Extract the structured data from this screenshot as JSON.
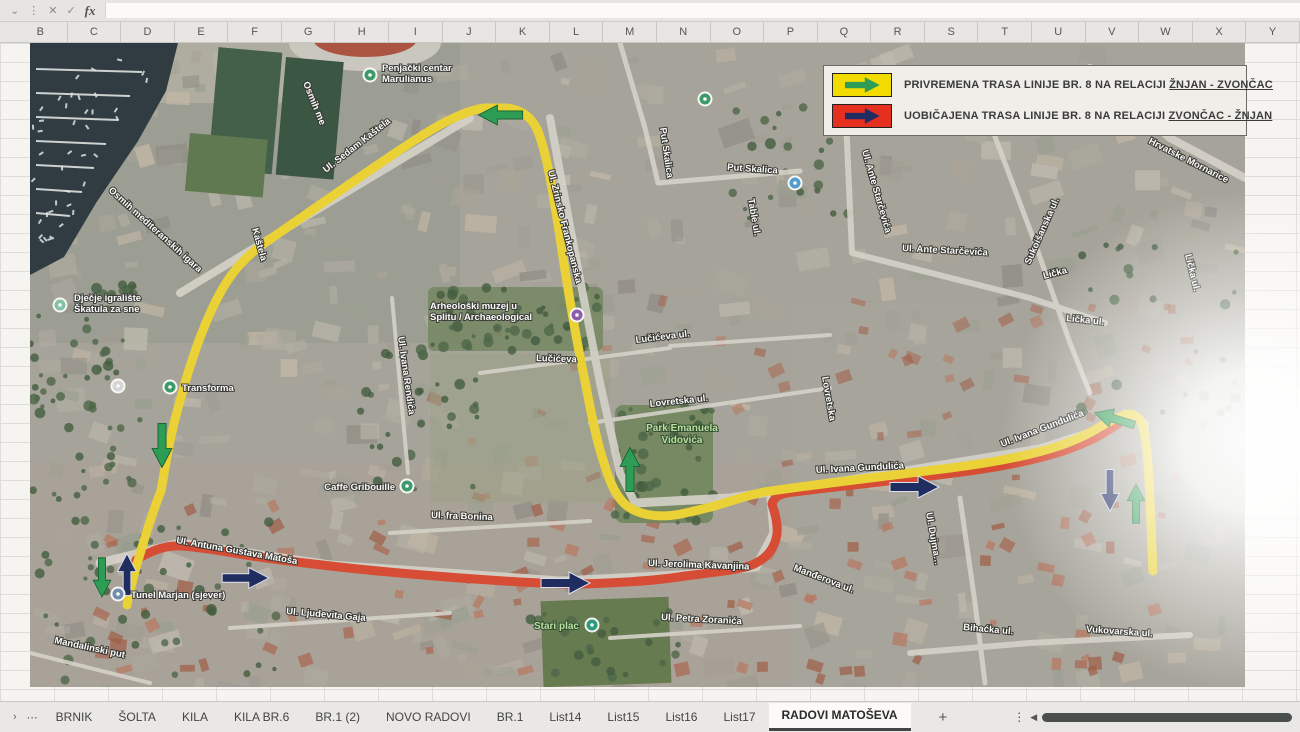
{
  "chrome": {
    "icons": {
      "name_box_chevron": "⌄",
      "menu_dots": "⋮",
      "cancel": "✕",
      "enter": "✓",
      "fx": "fx",
      "tab_nav": "›",
      "tab_overflow": "⋯",
      "add_sheet": "+",
      "tab_menu": "⋮",
      "scroll_left": "◀"
    }
  },
  "column_headers": [
    "B",
    "C",
    "D",
    "E",
    "F",
    "G",
    "H",
    "I",
    "J",
    "K",
    "L",
    "M",
    "N",
    "O",
    "P",
    "Q",
    "R",
    "S",
    "T",
    "U",
    "V",
    "W",
    "X",
    "Y"
  ],
  "legend": {
    "items": [
      {
        "prefix": "PRIVREMENA TRASA LINIJE BR. 8 NA RELACIJI ",
        "underlined": "ŽNJAN - ZVONČAC",
        "swatch_color": "#f2dc00",
        "arrow_color": "#1fa14c"
      },
      {
        "prefix": "UOBIČAJENA TRASA LINIJE BR. 8 NA RELACIJI ",
        "underlined": "ZVONČAC - ŽNJAN",
        "swatch_color": "#e6301f",
        "arrow_color": "#1b2a66"
      }
    ]
  },
  "map": {
    "routes": {
      "temporary_color": "#f2d41f",
      "usual_color": "#e8472b"
    },
    "street_labels": [
      {
        "t": "Osmih me",
        "x": 273,
        "y": 40,
        "r": 68
      },
      {
        "t": "Osmih mediteranskih igara",
        "x": 78,
        "y": 148,
        "r": 42
      },
      {
        "t": "Ul. Sedam Kaštela",
        "x": 296,
        "y": 130,
        "r": -38
      },
      {
        "t": "Kaštela",
        "x": 222,
        "y": 186,
        "r": 74
      },
      {
        "t": "Ul. Zrinsko Frankopanska",
        "x": 518,
        "y": 128,
        "r": 76
      },
      {
        "t": "Put Skalica",
        "x": 630,
        "y": 85,
        "r": 82
      },
      {
        "t": "Put Skalica",
        "x": 697,
        "y": 127,
        "r": 4
      },
      {
        "t": "Table ul.",
        "x": 718,
        "y": 156,
        "r": 80
      },
      {
        "t": "Ul. Ante Starčevića",
        "x": 832,
        "y": 108,
        "r": 74
      },
      {
        "t": "Ul. Ante Starčevića",
        "x": 872,
        "y": 208,
        "r": 3
      },
      {
        "t": "Hrvatske Mornarice",
        "x": 1118,
        "y": 100,
        "r": 27
      },
      {
        "t": "Sukoišanska ul.",
        "x": 1000,
        "y": 222,
        "r": -66
      },
      {
        "t": "Lička",
        "x": 1014,
        "y": 236,
        "r": -15
      },
      {
        "t": "Lička ul.",
        "x": 1036,
        "y": 278,
        "r": 6
      },
      {
        "t": "Lička ul.",
        "x": 1155,
        "y": 212,
        "r": 76
      },
      {
        "t": "Lučićeva",
        "x": 506,
        "y": 318,
        "r": 2
      },
      {
        "t": "Lučićeva ul.",
        "x": 606,
        "y": 300,
        "r": -7
      },
      {
        "t": "Lovretska ul.",
        "x": 620,
        "y": 364,
        "r": -6
      },
      {
        "t": "Lovretska",
        "x": 792,
        "y": 334,
        "r": 80
      },
      {
        "t": "Ul. Ivana Rendića",
        "x": 368,
        "y": 294,
        "r": 82
      },
      {
        "t": "Ul. Ivana Gundulića",
        "x": 786,
        "y": 430,
        "r": -3
      },
      {
        "t": "Ul. Ivana Gundulića",
        "x": 972,
        "y": 404,
        "r": -21
      },
      {
        "t": "Ul. fra Bonina",
        "x": 401,
        "y": 475,
        "r": 2
      },
      {
        "t": "Ul. Antuna Gustava Matoša",
        "x": 146,
        "y": 500,
        "r": 10
      },
      {
        "t": "Ul. Ljudevita Gaja",
        "x": 256,
        "y": 571,
        "r": 5
      },
      {
        "t": "Mandalinski put",
        "x": 24,
        "y": 600,
        "r": 12
      },
      {
        "t": "Ul. Jerolima Kavanjina",
        "x": 618,
        "y": 523,
        "r": 2
      },
      {
        "t": "Ul. Petra Zoranića",
        "x": 631,
        "y": 577,
        "r": 3
      },
      {
        "t": "Manđerova ul.",
        "x": 763,
        "y": 527,
        "r": 21
      },
      {
        "t": "Ul. Dujma…",
        "x": 896,
        "y": 470,
        "r": 80
      },
      {
        "t": "Bihaćka ul.",
        "x": 933,
        "y": 587,
        "r": 5
      },
      {
        "t": "Vukovarska ul.",
        "x": 1056,
        "y": 589,
        "r": 4
      }
    ],
    "pois": [
      {
        "name": "penjacki-centar",
        "lines": [
          "Penjački centar",
          "Marulianus"
        ],
        "x": 340,
        "y": 32,
        "c": "#2f9e63",
        "lx": 352,
        "ly": 28,
        "anchor": "start",
        "cls": "poi"
      },
      {
        "name": "djecje-igraliste",
        "lines": [
          "Dječje igralište",
          "Škatula za sne"
        ],
        "x": 30,
        "y": 262,
        "c": "#7fc5a3",
        "lx": 44,
        "ly": 258,
        "anchor": "start",
        "cls": "poi"
      },
      {
        "name": "transforma",
        "lines": [
          "Transforma"
        ],
        "x": 140,
        "y": 344,
        "c": "#2f9e63",
        "lx": 152,
        "ly": 348,
        "anchor": "start",
        "cls": "poi"
      },
      {
        "name": "arheoloski-muzej",
        "lines": [
          "Arheološki muzej u",
          "Splitu / Archaeological"
        ],
        "x": 547,
        "y": 272,
        "c": "#8e5bb5",
        "lx": 400,
        "ly": 266,
        "anchor": "start",
        "cls": "poi"
      },
      {
        "name": "caffe-gribouille",
        "lines": [
          "Caffe Gribouille"
        ],
        "x": 377,
        "y": 443,
        "c": "#2f9e63",
        "lx": 365,
        "ly": 447,
        "anchor": "end",
        "cls": "poi"
      },
      {
        "name": "stari-plac",
        "lines": [
          "Stari plac"
        ],
        "x": 562,
        "y": 582,
        "c": "#1f9e7a",
        "lx": 549,
        "ly": 586,
        "anchor": "end",
        "cls": "poi-green"
      },
      {
        "name": "tunel-marjan",
        "lines": [
          "Tunel Marjan (sjever)"
        ],
        "x": 88,
        "y": 551,
        "c": "#6b8fb3",
        "lx": 101,
        "ly": 555,
        "anchor": "start",
        "cls": "poi"
      },
      {
        "name": "poi-skalice",
        "lines": [],
        "x": 675,
        "y": 56,
        "c": "#2f9e63"
      },
      {
        "name": "poi-skalica-2",
        "lines": [],
        "x": 765,
        "y": 140,
        "c": "#4a9fd8"
      },
      {
        "name": "poi-field",
        "lines": [],
        "x": 88,
        "y": 343,
        "c": "#d8d8d8"
      }
    ],
    "park_labels": [
      {
        "lines": [
          "Park Emanuela",
          "Vidovića"
        ],
        "x": 652,
        "y": 388
      }
    ],
    "arrows": [
      {
        "x": 471,
        "y": 72,
        "r": 180,
        "c": "g",
        "s": 0.9
      },
      {
        "x": 132,
        "y": 402,
        "r": 90,
        "c": "g",
        "s": 0.9
      },
      {
        "x": 72,
        "y": 534,
        "r": 90,
        "c": "g",
        "s": 0.8
      },
      {
        "x": 97,
        "y": 532,
        "r": -90,
        "c": "n",
        "s": 0.85
      },
      {
        "x": 215,
        "y": 535,
        "r": 0,
        "c": "n",
        "s": 0.95
      },
      {
        "x": 535,
        "y": 540,
        "r": 0,
        "c": "n",
        "s": 1
      },
      {
        "x": 600,
        "y": 427,
        "r": -90,
        "c": "g",
        "s": 0.9
      },
      {
        "x": 884,
        "y": 444,
        "r": 0,
        "c": "n",
        "s": 1
      },
      {
        "x": 1085,
        "y": 376,
        "r": 197,
        "c": "g",
        "s": 0.85
      },
      {
        "x": 1080,
        "y": 447,
        "r": 90,
        "c": "n",
        "s": 0.85
      },
      {
        "x": 1106,
        "y": 461,
        "r": -90,
        "c": "g",
        "s": 0.8
      }
    ],
    "arrow_colors": {
      "g": {
        "fill": "#1fa14c",
        "stroke": "#0b6128"
      },
      "n": {
        "fill": "#1b2a66",
        "stroke": "#dfe4f2"
      }
    }
  },
  "sheet_tabs": {
    "tabs": [
      "BRNIK",
      "ŠOLTA",
      "KILA",
      "KILA BR.6",
      "BR.1 (2)",
      "NOVO RADOVI",
      "BR.1",
      "List14",
      "List15",
      "List16",
      "List17",
      "RADOVI MATOŠEVA"
    ],
    "active": "RADOVI MATOŠEVA"
  }
}
